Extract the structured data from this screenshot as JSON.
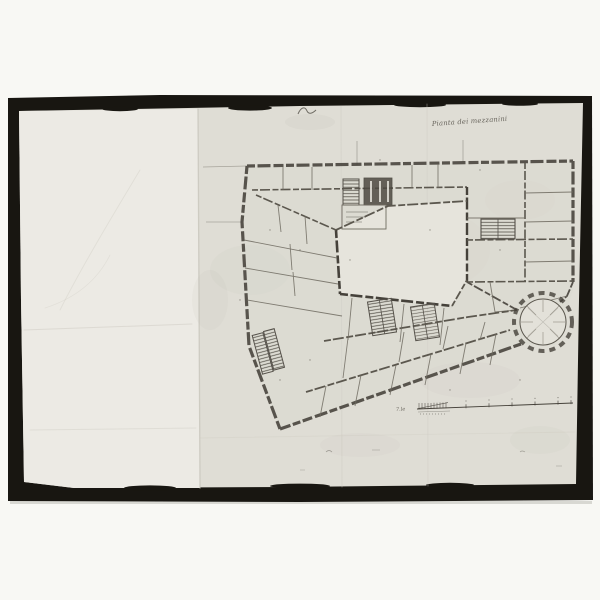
{
  "photo": {
    "description": "black-and-white photograph of a hand-drawn palazzo floor plan on aged folded paper",
    "frame_color": "#181611",
    "paper_left_color": "#eceae4",
    "paper_right_color": "#dfddd5",
    "ink_color": "#45413a"
  },
  "drawing": {
    "caption_handwritten": "Pianta dei mezzanini",
    "scale_bar": {
      "label": "7.le",
      "major_ticks": 6
    },
    "features": [
      "outer-walls",
      "main-courtyard",
      "top-wing-rooms",
      "right-wing-rooms",
      "grand-staircase",
      "service-staircases",
      "oval-hall",
      "scale-bar",
      "fold-creases"
    ]
  }
}
